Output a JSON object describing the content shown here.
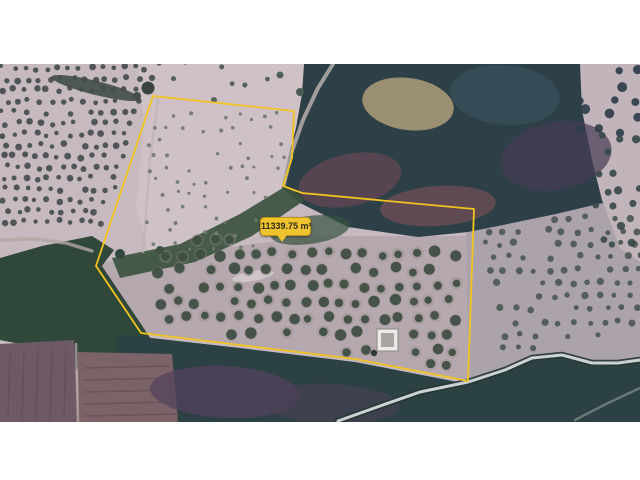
{
  "scene": {
    "description": "satellite-imagery-with-area-measurement",
    "canvas_bg": "#ffffff",
    "image_area": {
      "x": 0,
      "y": 64,
      "width": 640,
      "height": 358
    },
    "base_color": "#c6b9bf"
  },
  "measurement": {
    "area_label": "11339.75 m²",
    "line_color": "#f2c41d",
    "label_bg": "#efc42f",
    "label_border": "#bd9416",
    "label_text_color": "#332c15",
    "label_box": {
      "x": 260,
      "y": 217,
      "w": 51,
      "h": 19,
      "tail_tip_x": 281
    },
    "polygon_points": [
      [
        153,
        96
      ],
      [
        294,
        111
      ],
      [
        292,
        158
      ],
      [
        283,
        186
      ],
      [
        302,
        193
      ],
      [
        474,
        209
      ],
      [
        468,
        381
      ],
      [
        355,
        359
      ],
      [
        141,
        333
      ],
      [
        96,
        266
      ]
    ]
  },
  "terrain": {
    "regions": [
      {
        "name": "field-upper-lobe",
        "points": [
          [
            138,
            64
          ],
          [
            314,
            64
          ],
          [
            302,
            118
          ],
          [
            286,
            188
          ],
          [
            300,
            200
          ],
          [
            262,
            224
          ],
          [
            198,
            250
          ],
          [
            152,
            264
          ],
          [
            136,
            208
          ],
          [
            144,
            122
          ]
        ],
        "fill": "#cfc2c7"
      },
      {
        "name": "field-lower-lobe",
        "points": [
          [
            98,
            264
          ],
          [
            162,
            250
          ],
          [
            240,
            246
          ],
          [
            312,
            236
          ],
          [
            470,
            236
          ],
          [
            470,
            382
          ],
          [
            352,
            360
          ],
          [
            138,
            332
          ]
        ],
        "fill": "#b5a8af"
      },
      {
        "name": "field-right",
        "points": [
          [
            466,
            206
          ],
          [
            640,
            192
          ],
          [
            640,
            364
          ],
          [
            598,
            364
          ],
          [
            560,
            354
          ],
          [
            520,
            362
          ],
          [
            468,
            382
          ]
        ],
        "fill": "#aba2ac"
      },
      {
        "name": "forest-main",
        "points": [
          [
            304,
            64
          ],
          [
            640,
            64
          ],
          [
            640,
            196
          ],
          [
            598,
            204
          ],
          [
            556,
            214
          ],
          [
            498,
            226
          ],
          [
            468,
            232
          ],
          [
            418,
            237
          ],
          [
            348,
            227
          ],
          [
            300,
            203
          ],
          [
            282,
            188
          ],
          [
            288,
            158
          ],
          [
            296,
            128
          ],
          [
            302,
            94
          ]
        ],
        "fill": "#2d4047"
      },
      {
        "name": "forest-left-creek",
        "points": [
          [
            0,
            258
          ],
          [
            42,
            246
          ],
          [
            92,
            236
          ],
          [
            114,
            250
          ],
          [
            102,
            266
          ],
          [
            145,
            330
          ],
          [
            158,
            350
          ],
          [
            162,
            376
          ],
          [
            130,
            392
          ],
          [
            84,
            374
          ],
          [
            40,
            348
          ],
          [
            0,
            340
          ]
        ],
        "fill": "#2f4839"
      },
      {
        "name": "forest-bottom",
        "points": [
          [
            116,
            334
          ],
          [
            240,
            348
          ],
          [
            355,
            362
          ],
          [
            468,
            384
          ],
          [
            505,
            371
          ],
          [
            533,
            358
          ],
          [
            562,
            355
          ],
          [
            600,
            366
          ],
          [
            640,
            362
          ],
          [
            640,
            422
          ],
          [
            116,
            422
          ]
        ],
        "fill": "#2b4143"
      },
      {
        "name": "stream-band",
        "points": [
          [
            286,
            186
          ],
          [
            240,
            214
          ],
          [
            180,
            244
          ],
          [
            112,
            258
          ],
          [
            120,
            278
          ],
          [
            195,
            262
          ],
          [
            252,
            236
          ],
          [
            305,
            200
          ]
        ],
        "fill": "#3c5240",
        "op": 0.92
      },
      {
        "name": "clearing-top-right",
        "points": [
          [
            580,
            64
          ],
          [
            640,
            64
          ],
          [
            640,
            262
          ],
          [
            620,
            248
          ],
          [
            602,
            200
          ],
          [
            592,
            160
          ],
          [
            582,
            110
          ]
        ],
        "fill": "#c1b5bb"
      },
      {
        "name": "plow-left",
        "points": [
          [
            0,
            344
          ],
          [
            74,
            340
          ],
          [
            78,
            422
          ],
          [
            0,
            422
          ]
        ],
        "fill": "#6d5a66"
      },
      {
        "name": "plow-right",
        "points": [
          [
            78,
            352
          ],
          [
            172,
            354
          ],
          [
            178,
            422
          ],
          [
            78,
            422
          ]
        ],
        "fill": "#7b6367"
      }
    ],
    "patches": [
      {
        "name": "tan-clearing",
        "cx": 408,
        "cy": 104,
        "rx": 46,
        "ry": 26,
        "rot": 8,
        "fill": "#a19374",
        "op": 0.95
      },
      {
        "name": "maroon-patch-1",
        "cx": 350,
        "cy": 180,
        "rx": 52,
        "ry": 26,
        "rot": -12,
        "fill": "#5e4752",
        "op": 0.85
      },
      {
        "name": "maroon-patch-2",
        "cx": 438,
        "cy": 206,
        "rx": 58,
        "ry": 20,
        "rot": -4,
        "fill": "#6a4c52",
        "op": 0.8
      },
      {
        "name": "purple-patch",
        "cx": 556,
        "cy": 156,
        "rx": 56,
        "ry": 34,
        "rot": -10,
        "fill": "#463b54",
        "op": 0.7
      },
      {
        "name": "teal-light-patch",
        "cx": 505,
        "cy": 95,
        "rx": 55,
        "ry": 30,
        "rot": 5,
        "fill": "#3a5560",
        "op": 0.6
      },
      {
        "name": "hedge-top-left",
        "cx": 96,
        "cy": 88,
        "rx": 46,
        "ry": 7,
        "rot": 14,
        "fill": "#414f48",
        "op": 0.9
      },
      {
        "name": "plow-purple-1",
        "cx": 225,
        "cy": 392,
        "rx": 75,
        "ry": 26,
        "rot": 3,
        "fill": "#54415c",
        "op": 0.75
      },
      {
        "name": "plow-purple-2",
        "cx": 330,
        "cy": 404,
        "rx": 70,
        "ry": 20,
        "rot": 2,
        "fill": "#4a3f55",
        "op": 0.6
      },
      {
        "name": "soil-streak",
        "cx": 253,
        "cy": 276,
        "rx": 21,
        "ry": 5,
        "rot": -10,
        "fill": "#d6cbce",
        "op": 0.85
      },
      {
        "name": "forest-green-edge",
        "cx": 310,
        "cy": 230,
        "rx": 40,
        "ry": 14,
        "rot": -8,
        "fill": "#37523f",
        "op": 0.7
      }
    ],
    "tracks": [
      {
        "name": "track-top",
        "points": [
          [
            333,
            64
          ],
          [
            318,
            88
          ],
          [
            303,
            120
          ],
          [
            291,
            154
          ],
          [
            284,
            184
          ]
        ],
        "stroke": "#b6aeab",
        "w": 4,
        "op": 0.85
      },
      {
        "name": "track-left",
        "points": [
          [
            0,
            240
          ],
          [
            36,
            239
          ],
          [
            66,
            243
          ],
          [
            92,
            251
          ]
        ],
        "stroke": "#b2a7a4",
        "w": 3.5,
        "op": 0.8
      },
      {
        "name": "track-upper-lobe",
        "points": [
          [
            158,
            100
          ],
          [
            150,
            160
          ],
          [
            146,
            214
          ],
          [
            143,
            252
          ]
        ],
        "stroke": "#beb2b6",
        "w": 2.5,
        "op": 0.7
      },
      {
        "name": "plow-divider",
        "points": [
          [
            76,
            344
          ],
          [
            78,
            422
          ]
        ],
        "stroke": "#b0a1a3",
        "w": 2.5,
        "op": 0.8
      },
      {
        "name": "track-corner",
        "points": [
          [
            575,
            420
          ],
          [
            606,
            404
          ],
          [
            640,
            388
          ]
        ],
        "stroke": "#9aa4a3",
        "w": 2.5,
        "op": 0.55
      }
    ],
    "stripes": [
      {
        "x1": 10,
        "y1": 350,
        "x2": 8,
        "y2": 420
      },
      {
        "x1": 24,
        "y1": 349,
        "x2": 22,
        "y2": 420
      },
      {
        "x1": 38,
        "y1": 348,
        "x2": 36,
        "y2": 420
      },
      {
        "x1": 52,
        "y1": 347,
        "x2": 50,
        "y2": 420
      },
      {
        "x1": 66,
        "y1": 346,
        "x2": 64,
        "y2": 420
      },
      {
        "x1": 84,
        "y1": 368,
        "x2": 170,
        "y2": 366
      },
      {
        "x1": 84,
        "y1": 380,
        "x2": 172,
        "y2": 378
      },
      {
        "x1": 84,
        "y1": 392,
        "x2": 174,
        "y2": 390
      },
      {
        "x1": 84,
        "y1": 404,
        "x2": 175,
        "y2": 402
      },
      {
        "x1": 84,
        "y1": 416,
        "x2": 176,
        "y2": 414
      }
    ],
    "stripe_style": {
      "stroke": "#5c4a57",
      "w": 1.6,
      "op": 0.55
    },
    "roads": [
      {
        "name": "main-road",
        "points": [
          [
            338,
            421
          ],
          [
            380,
            406
          ],
          [
            420,
            392
          ],
          [
            468,
            382
          ],
          [
            505,
            370
          ],
          [
            532,
            358
          ],
          [
            562,
            355
          ],
          [
            592,
            363
          ],
          [
            618,
            363
          ],
          [
            640,
            360
          ]
        ],
        "casing": "#263735",
        "casingW": 6.5,
        "inner": "#ccd2d4",
        "innerW": 3
      }
    ],
    "groves": [
      {
        "name": "upper-left-grove",
        "x0": 3,
        "x1": 150,
        "y0": 68,
        "y1": 232,
        "dx": 11,
        "dy": 11,
        "r": 2.7,
        "jitter": 2.2,
        "density": 0.93,
        "color": "#454c4e",
        "constraints": [
          [
            170,
            57,
            30480
          ]
        ]
      },
      {
        "name": "upper-lobe-saplings",
        "x0": 150,
        "x1": 288,
        "y0": 116,
        "y1": 256,
        "dx": 13,
        "dy": 13,
        "r": 1.9,
        "jitter": 3.5,
        "density": 0.6,
        "color": "#70796d",
        "constraints": [
          [
            -170,
            -57,
            -32282
          ],
          [
            1,
            0.35,
            352
          ]
        ]
      },
      {
        "name": "lower-grove",
        "x0": 160,
        "x1": 462,
        "y0": 238,
        "y1": 374,
        "dx": 18,
        "dy": 16,
        "r": 4.6,
        "jitter": 3,
        "density": 0.92,
        "color": "#3e4d40",
        "halo": "#958b84",
        "constraints": [
          [
            -0.146,
            1,
            302
          ],
          [
            0.045,
            -1,
            -228
          ],
          [
            -1.512,
            1,
            109
          ],
          [
            1,
            0,
            462
          ]
        ],
        "holes": [
          {
            "x": 368,
            "y": 320,
            "w": 42,
            "h": 40
          }
        ]
      },
      {
        "name": "right-field-rows",
        "x0": 480,
        "x1": 638,
        "y0": 218,
        "y1": 348,
        "dx": 15,
        "dy": 13,
        "r": 3,
        "jitter": 2,
        "density": 0.85,
        "color": "#4c5852",
        "skew": 0.18,
        "constraints": [
          [
            -0.19,
            -1,
            -318
          ],
          [
            0.2,
            1,
            456
          ]
        ]
      },
      {
        "name": "corner-scatter",
        "x0": 584,
        "x1": 638,
        "y0": 68,
        "y1": 128,
        "dx": 17,
        "dy": 15,
        "r": 4.5,
        "jitter": 5,
        "density": 0.65,
        "color": "#2f3d4a"
      },
      {
        "name": "far-right-scatter",
        "x0": 600,
        "x1": 638,
        "y0": 135,
        "y1": 258,
        "dx": 16,
        "dy": 18,
        "r": 3.8,
        "jitter": 5,
        "density": 0.6,
        "color": "#3a4a4a"
      },
      {
        "name": "top-strip-scatter",
        "x0": 162,
        "x1": 298,
        "y0": 66,
        "y1": 92,
        "dx": 20,
        "dy": 14,
        "r": 2.6,
        "jitter": 5,
        "density": 0.45,
        "color": "#4e5a54"
      }
    ],
    "blobs": [
      {
        "x": 148,
        "y": 88,
        "r": 6.5,
        "fill": "#39433f"
      },
      {
        "x": 137,
        "y": 96,
        "r": 4,
        "fill": "#434e48"
      },
      {
        "x": 374,
        "y": 353,
        "r": 3.2,
        "fill": "#2e3b36"
      },
      {
        "x": 300,
        "y": 92,
        "r": 4,
        "fill": "#4a5a52"
      },
      {
        "x": 280,
        "y": 75,
        "r": 3.5,
        "fill": "#50605a"
      },
      {
        "x": 214,
        "y": 100,
        "r": 3,
        "fill": "#55645c"
      },
      {
        "x": 120,
        "y": 254,
        "r": 5,
        "fill": "#34493b"
      },
      {
        "x": 160,
        "y": 250,
        "r": 4,
        "fill": "#3c523f"
      }
    ],
    "building": {
      "x": 377,
      "y": 329,
      "w": 21,
      "h": 22,
      "wall": "#edebe7",
      "roof": "#aaa6a2"
    }
  }
}
